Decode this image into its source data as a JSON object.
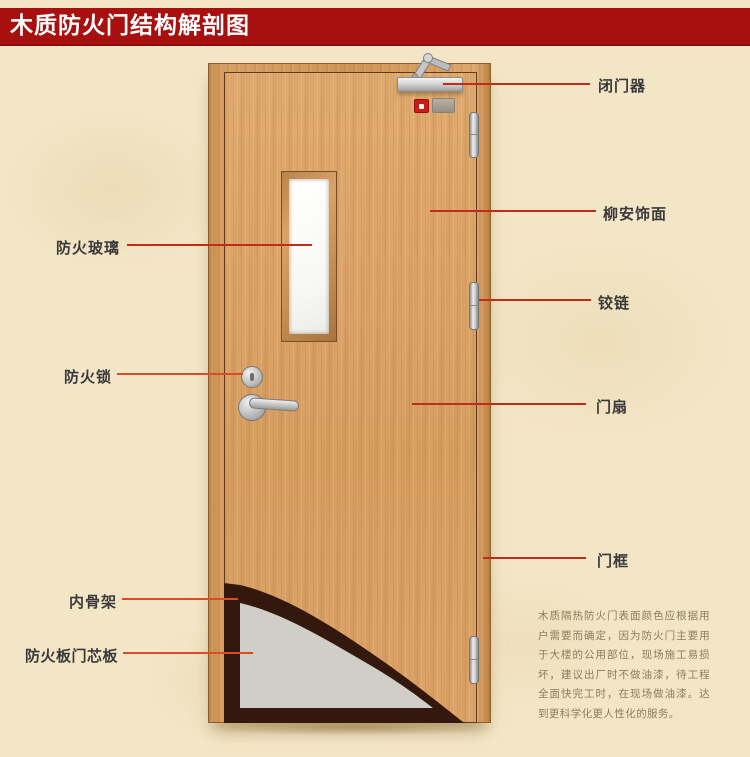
{
  "title": "木质防火门结构解剖图",
  "colors": {
    "banner": "#a80f0f",
    "callout_line": "#c12c1a",
    "callout_line_warm": "#d84d28",
    "label_text": "#3a3a3a",
    "background": "#f3e6c7",
    "door_wood": "#d79e62",
    "core_gray": "#cfcfc7",
    "inner_skeleton": "#33180d",
    "description_text": "#8b7c5e"
  },
  "callouts": {
    "right": [
      {
        "label": "闭门器"
      },
      {
        "label": "柳安饰面"
      },
      {
        "label": "铰链"
      },
      {
        "label": "门扇"
      },
      {
        "label": "门框"
      }
    ],
    "left": [
      {
        "label": "防火玻璃"
      },
      {
        "label": "防火锁"
      },
      {
        "label": "内骨架"
      },
      {
        "label": "防火板门芯板"
      }
    ]
  },
  "description": "木质隔热防火门表面颜色应根据用户需要而确定，因为防火门主要用于大楼的公用部位，现场施工易损坏，建议出厂时不做油漆，待工程全面快完工时，在现场做油漆。达到更科学化更人性化的服务。"
}
